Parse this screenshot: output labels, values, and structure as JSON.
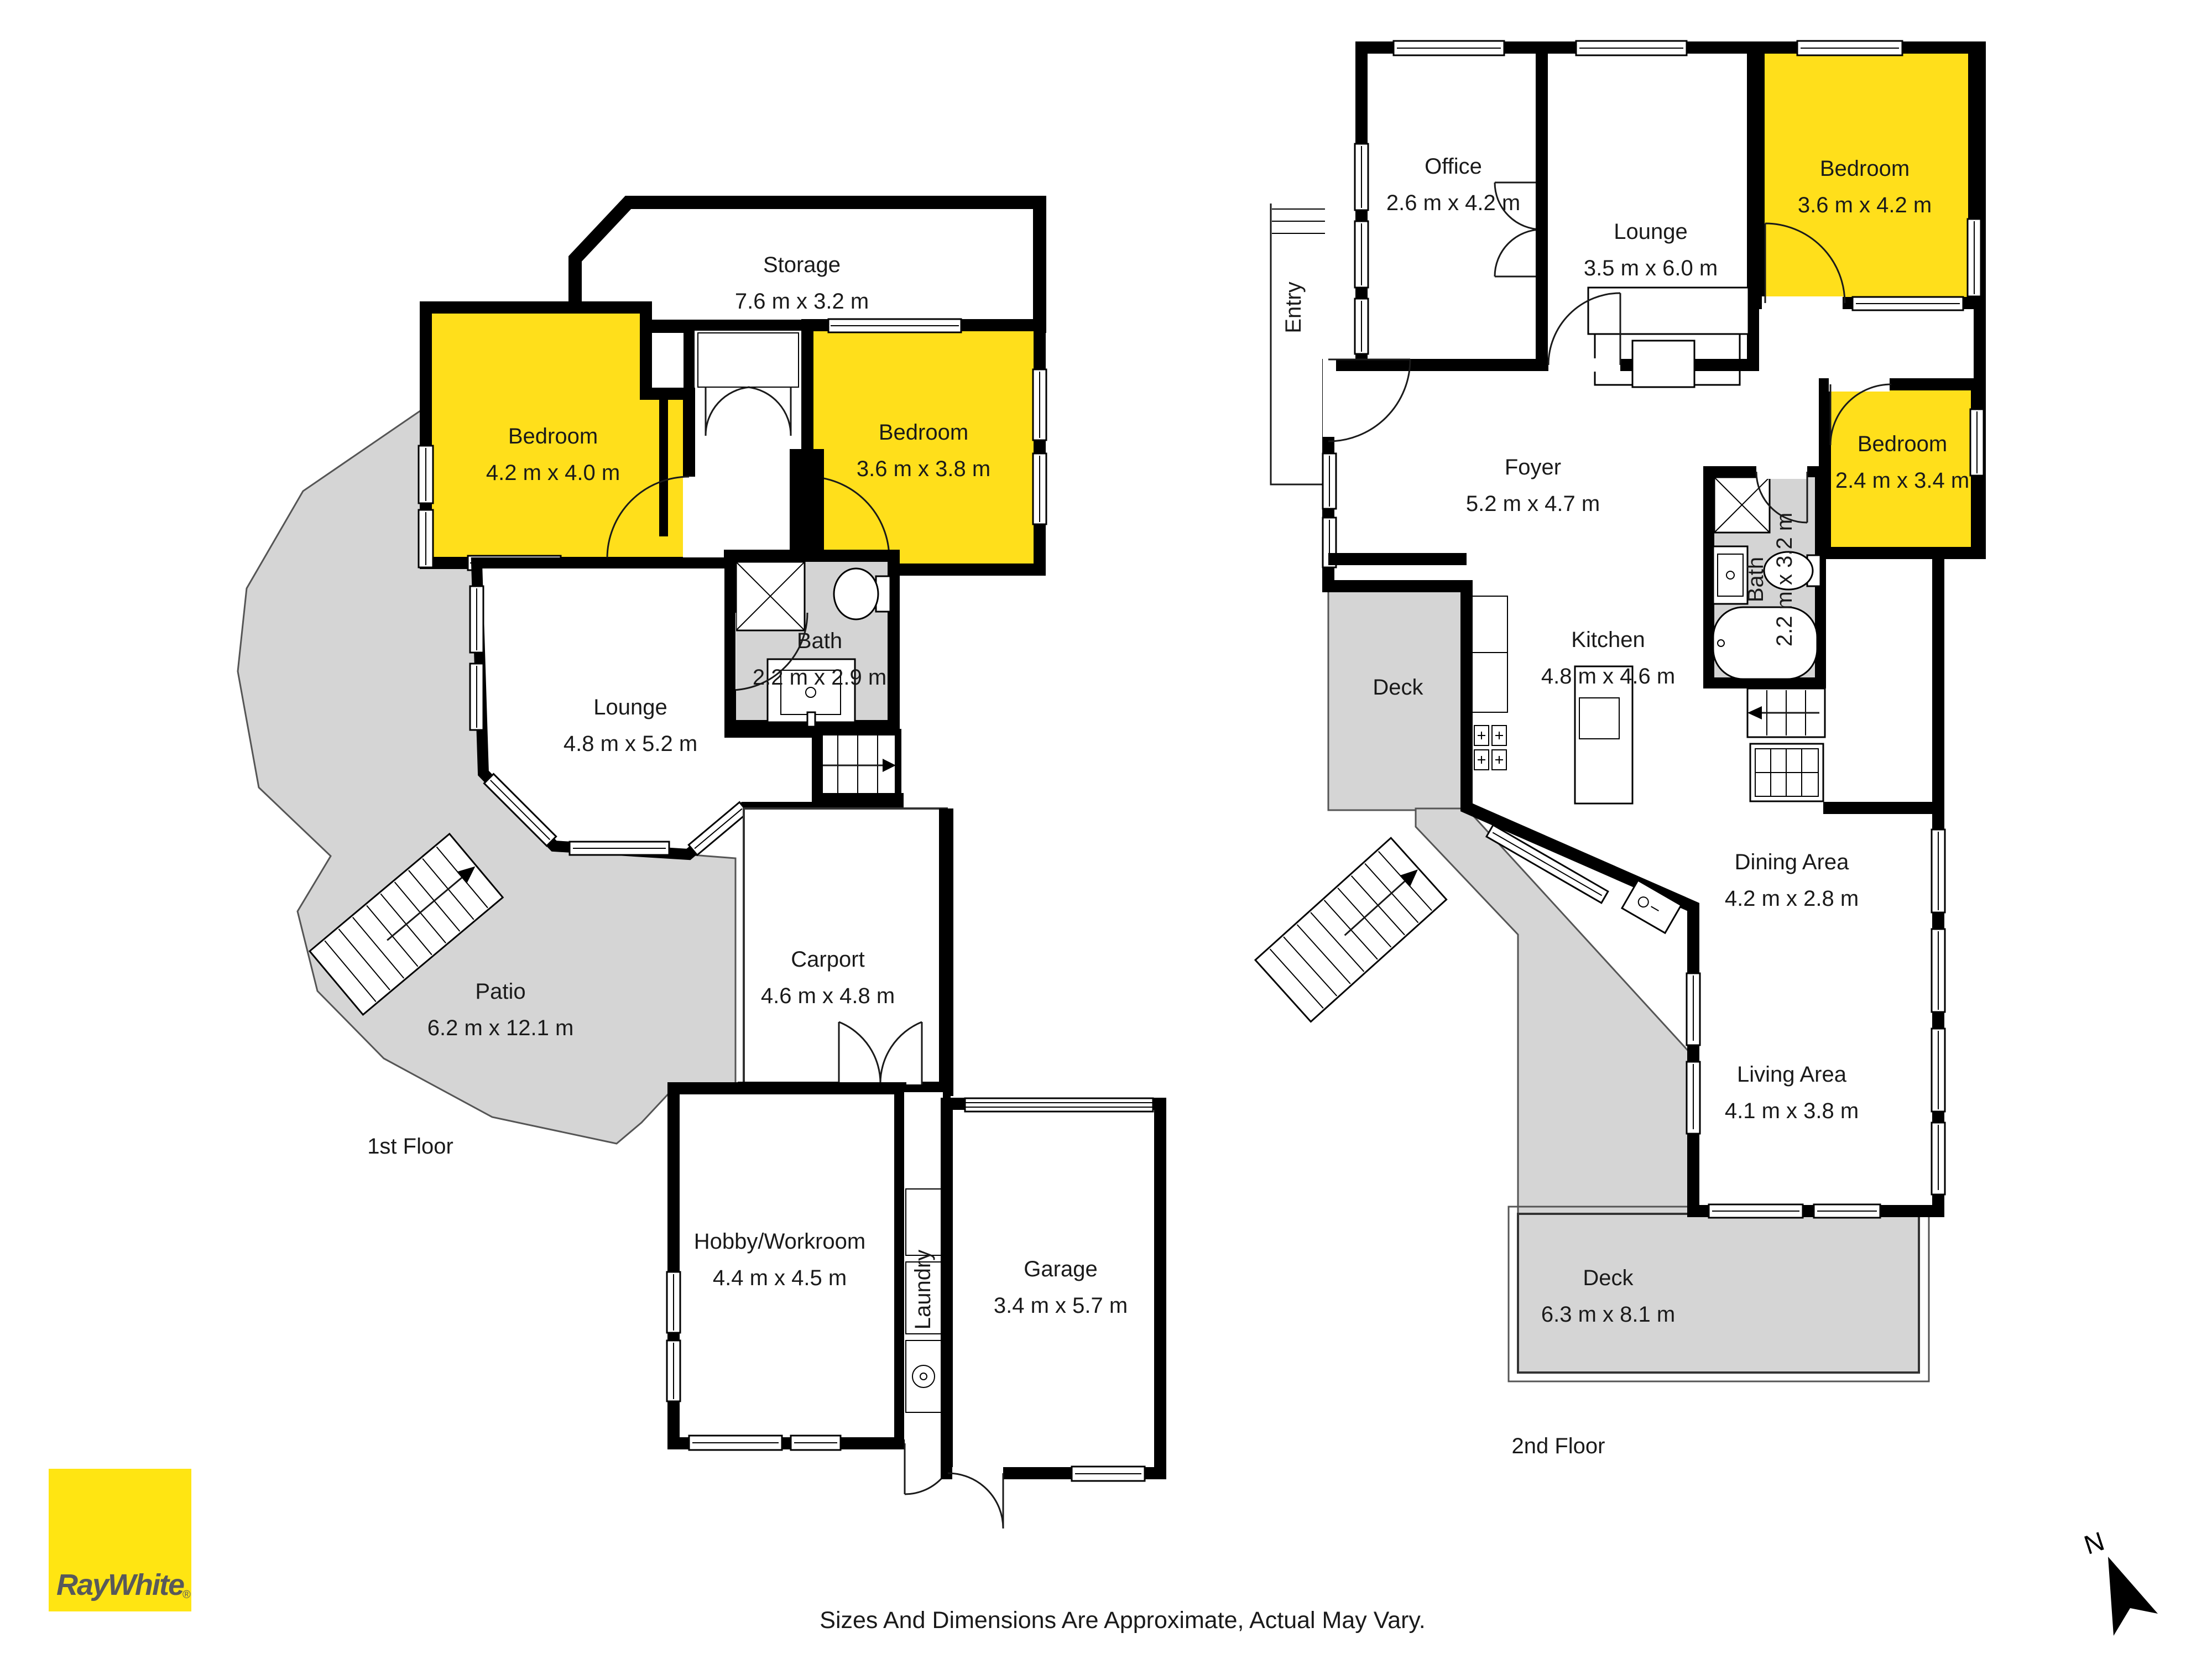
{
  "floor1": {
    "label": "1st Floor",
    "storage_name": "Storage",
    "storage_dims": "7.6 m x 3.2 m",
    "bedroom1_name": "Bedroom",
    "bedroom1_dims": "4.2 m x 4.0 m",
    "bedroom2_name": "Bedroom",
    "bedroom2_dims": "3.6 m x 3.8 m",
    "bath_name": "Bath",
    "bath_dims": "2.2 m x 2.9 m",
    "lounge_name": "Lounge",
    "lounge_dims": "4.8 m x 5.2 m",
    "patio_name": "Patio",
    "patio_dims": "6.2 m x 12.1 m",
    "carport_name": "Carport",
    "carport_dims": "4.6 m x 4.8 m",
    "hobby_name": "Hobby/Workroom",
    "hobby_dims": "4.4 m x 4.5 m",
    "laundry_name": "Laundry",
    "garage_name": "Garage",
    "garage_dims": "3.4 m x 5.7 m"
  },
  "floor2": {
    "label": "2nd Floor",
    "office_name": "Office",
    "office_dims": "2.6 m x 4.2 m",
    "lounge_name": "Lounge",
    "lounge_dims": "3.5 m x 6.0 m",
    "bedroom_top_name": "Bedroom",
    "bedroom_top_dims": "3.6 m x 4.2 m",
    "entry_name": "Entry",
    "foyer_name": "Foyer",
    "foyer_dims": "5.2 m x 4.7 m",
    "bedroom_mid_name": "Bedroom",
    "bedroom_mid_dims": "2.4 m x 3.4 m",
    "bath_name": "Bath",
    "bath_dims": "2.2 m x 3.2 m",
    "kitchen_name": "Kitchen",
    "kitchen_dims": "4.8 m x 4.6 m",
    "deck_upper_name": "Deck",
    "dining_name": "Dining Area",
    "dining_dims": "4.2 m x 2.8 m",
    "living_name": "Living Area",
    "living_dims": "4.1 m x 3.8 m",
    "deck_lower_name": "Deck",
    "deck_lower_dims": "6.3 m x 8.1 m"
  },
  "footer": {
    "disclaimer": "Sizes And Dimensions Are Approximate, Actual May Vary.",
    "brand": "RayWhite",
    "registered": "®",
    "north": "N"
  },
  "colors": {
    "highlight_yellow": "#FFDF1B",
    "brand_yellow": "#FFE512",
    "brand_gray": "#58595B",
    "outdoor_gray": "#D5D5D5",
    "wall_black": "#000000"
  }
}
